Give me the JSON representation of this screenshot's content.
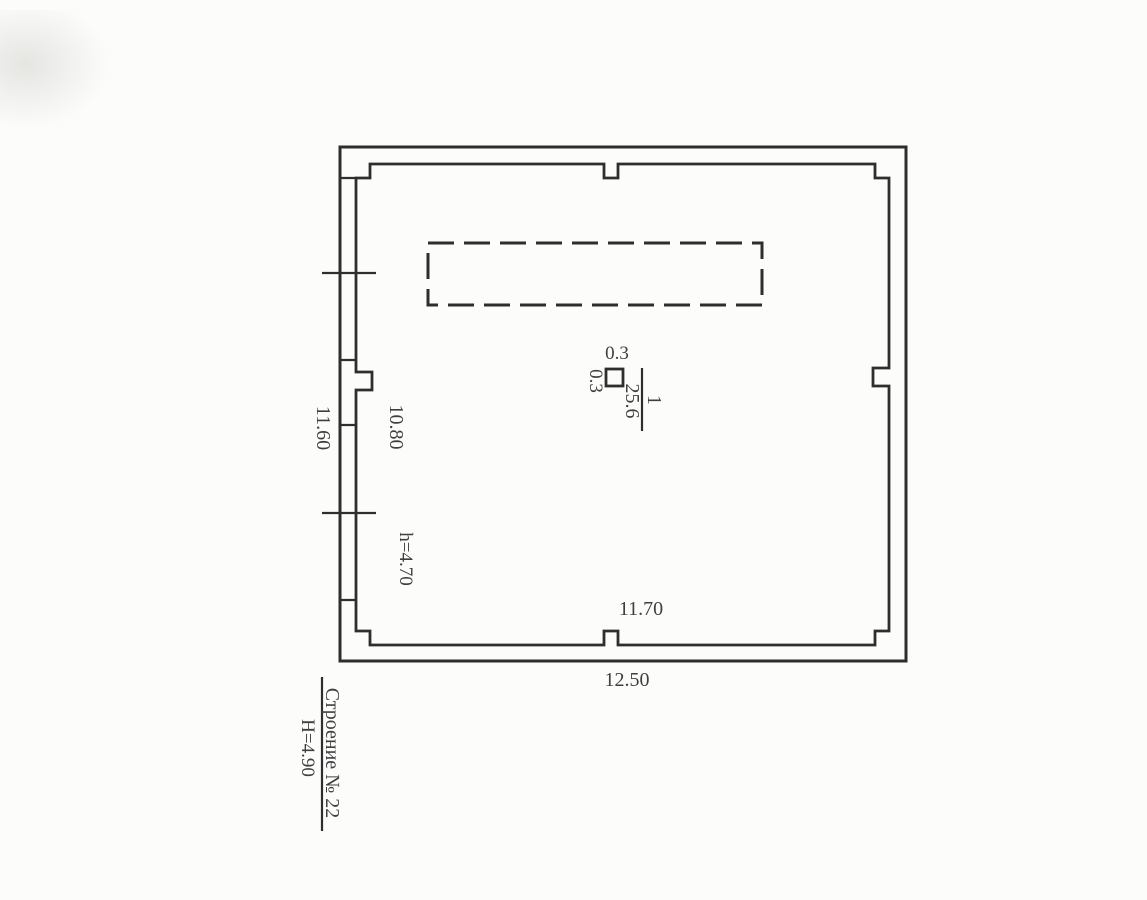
{
  "plan": {
    "labels": {
      "column_size_top": "0.3",
      "column_size_side": "0.3",
      "room_number": "1",
      "room_area": "25.6",
      "dim_left_outer": "11.60",
      "dim_left_inner": "10.80",
      "ceiling_height": "h=4.70",
      "dim_bottom_inner": "11.70",
      "dim_bottom_outer": "12.50"
    },
    "title": {
      "building_name": "Строение № 22",
      "building_height": "Н=4.90"
    },
    "colors": {
      "ink": "#2e2e2e",
      "text": "#3f3f3f",
      "paper": "#fcfcfb"
    }
  }
}
